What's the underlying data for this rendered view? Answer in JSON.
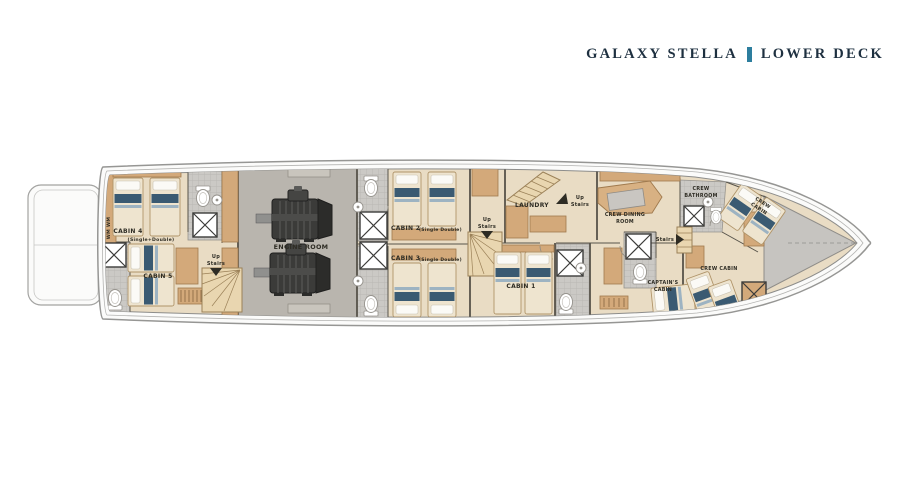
{
  "header": {
    "boat_name": "GALAXY STELLA",
    "deck_name": "LOWER DECK"
  },
  "plan": {
    "cabin4": {
      "name": "CABIN 4",
      "type": "(Single+Double)"
    },
    "cabin5": {
      "name": "CABIN 5"
    },
    "engine_room": {
      "name": "ENGINE ROOM"
    },
    "cabin2": {
      "name": "CABIN 2",
      "type": "(Single Double)"
    },
    "cabin3": {
      "name": "CABIN 3",
      "type": "(Single Double)"
    },
    "laundry": {
      "name": "LAUNDRY"
    },
    "cabin1": {
      "name": "CABIN 1"
    },
    "crew_dining": {
      "line1": "CREW DINING",
      "line2": "ROOM"
    },
    "captains_cabin": {
      "line1": "CAPTAIN'S",
      "line2": "CABIN"
    },
    "crew_bathroom": {
      "line1": "CREW",
      "line2": "BATHROOM"
    },
    "crew_cabin_fwd": {
      "line1": "CREW",
      "line2": "CABIN"
    },
    "crew_cabin_aft": {
      "name": "CREW CABIN"
    },
    "stairs": {
      "up": "Up",
      "stairs": "Stairs",
      "stairs_only": "Stairs"
    },
    "wardrobe": {
      "label": "WM WM"
    }
  },
  "colors": {
    "accent_bar": "#2d7e9e",
    "hull_outline": "#9a9a98",
    "floor": "#e9dcc4",
    "wood": "#d3a97a",
    "engine_floor": "#b9b5ae",
    "bed_accent": "#3a5a72"
  }
}
